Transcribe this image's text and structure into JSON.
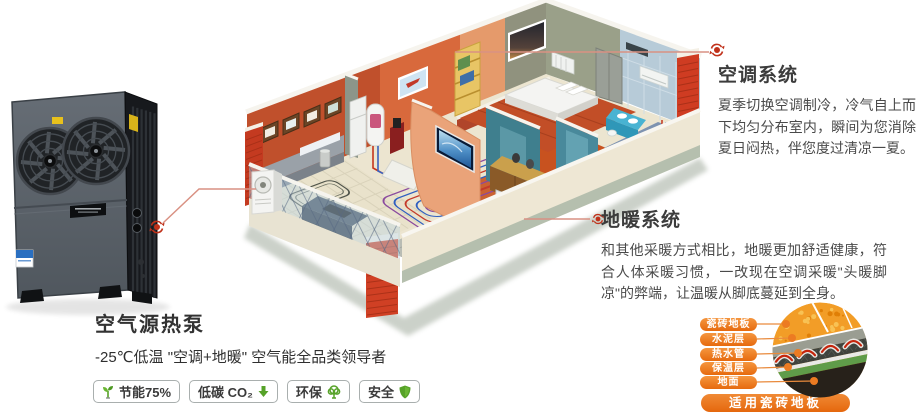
{
  "product": {
    "name": "空气源热泵",
    "tagline": "-25℃低温 \"空调+地暖\" 空气能全品类领导者",
    "badges": [
      {
        "icon": "sprout-icon",
        "label": "节能75%"
      },
      {
        "icon": "co2-down-arrow-icon",
        "label": "低碳 CO₂"
      },
      {
        "icon": "tree-icon",
        "label": "环保"
      },
      {
        "icon": "shield-icon",
        "label": "安全"
      }
    ]
  },
  "sections": {
    "ac": {
      "title": "空调系统",
      "body": "夏季切换空调制冷，冷气自上而下均匀分布室内，瞬间为您消除夏日闷热，伴您度过清凉一夏。"
    },
    "heating": {
      "title": "地暖系统",
      "body": "和其他采暖方式相比，地暖更加舒适健康，符合人体采暖习惯，一改现在空调采暖\"头暖脚凉\"的弊端，让温暖从脚底蔓延到全身。"
    }
  },
  "floor_structure": {
    "layers": [
      "瓷砖地板",
      "水泥层",
      "热水管",
      "保温层",
      "地面"
    ],
    "caption": "适用瓷砖地板"
  },
  "colors": {
    "accent_orange": "#ed7b23",
    "leader_red": "#c0311a",
    "badge_green": "#56a228"
  }
}
